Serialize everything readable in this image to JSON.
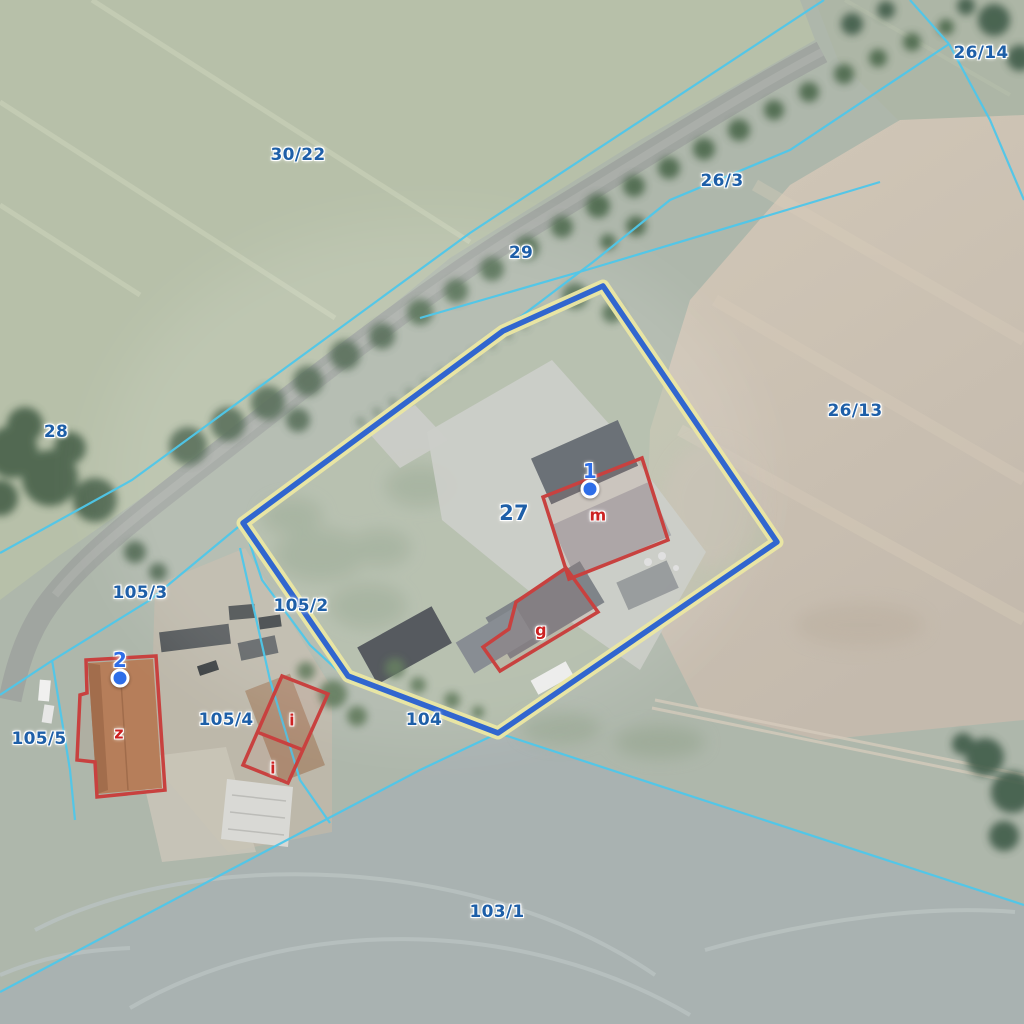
{
  "map": {
    "type": "cadastral-orthophoto-view",
    "parcel_labels": [
      {
        "text": "30/22",
        "x": 298,
        "y": 155
      },
      {
        "text": "26/14",
        "x": 981,
        "y": 53
      },
      {
        "text": "26/3",
        "x": 722,
        "y": 181
      },
      {
        "text": "29",
        "x": 521,
        "y": 253
      },
      {
        "text": "28",
        "x": 56,
        "y": 432
      },
      {
        "text": "26/13",
        "x": 855,
        "y": 411
      },
      {
        "text": "27",
        "x": 514,
        "y": 513,
        "emphasis": true
      },
      {
        "text": "105/3",
        "x": 140,
        "y": 593
      },
      {
        "text": "105/2",
        "x": 301,
        "y": 606
      },
      {
        "text": "105/4",
        "x": 226,
        "y": 720
      },
      {
        "text": "105/5",
        "x": 39,
        "y": 739
      },
      {
        "text": "104",
        "x": 424,
        "y": 720
      },
      {
        "text": "103/1",
        "x": 497,
        "y": 912
      }
    ],
    "building_labels": [
      {
        "text": "m",
        "x": 598,
        "y": 515
      },
      {
        "text": "g",
        "x": 541,
        "y": 630
      },
      {
        "text": "i",
        "x": 292,
        "y": 720
      },
      {
        "text": "i",
        "x": 273,
        "y": 768
      },
      {
        "text": "z",
        "x": 119,
        "y": 733
      }
    ],
    "point_markers": [
      {
        "label": "1",
        "x": 590,
        "y": 489
      },
      {
        "label": "2",
        "x": 120,
        "y": 678
      }
    ],
    "colors": {
      "parcel_label": "#1e5fa8",
      "building_label": "#cc2222",
      "boundary_line": "#4ec7ea",
      "selection_outline": "#3166cf",
      "selection_casing": "#ebe7a3",
      "building_outline": "#c8413f",
      "marker": "#2e6ee8"
    }
  }
}
